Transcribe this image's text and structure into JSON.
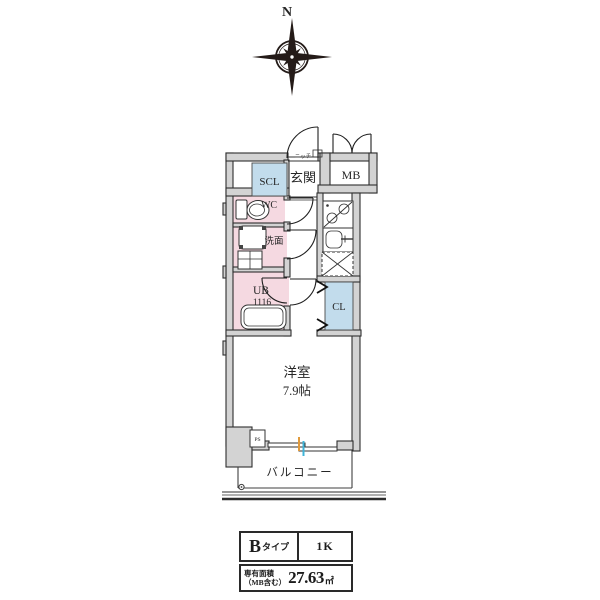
{
  "compass": {
    "label": "N"
  },
  "plan": {
    "labels": {
      "scl": "SCL",
      "niche": "ニッチ",
      "entrance": "玄関",
      "meter_box": "MB",
      "toilet": "WC",
      "washroom": "洗面",
      "unit_bath": "UB",
      "unit_bath_size": "1116",
      "closet": "CL",
      "main_room": "洋室",
      "main_room_size": "7.9帖",
      "pipe_space": "PS",
      "balcony": "バルコニー"
    },
    "colors": {
      "wall_fill": "#d3d3d3",
      "wet_area_fill": "#f5d9e1",
      "storage_fill": "#c2dcec",
      "window_accent_orange": "#e09a3c",
      "window_accent_cyan": "#3fb4d8"
    }
  },
  "spec_table": {
    "type_main": "B",
    "type_suffix": "タイプ",
    "layout_type": "1K",
    "area_label_line1": "専有面積",
    "area_label_line2": "（MB含む）",
    "area_value": "27.63",
    "area_unit": "㎡"
  }
}
